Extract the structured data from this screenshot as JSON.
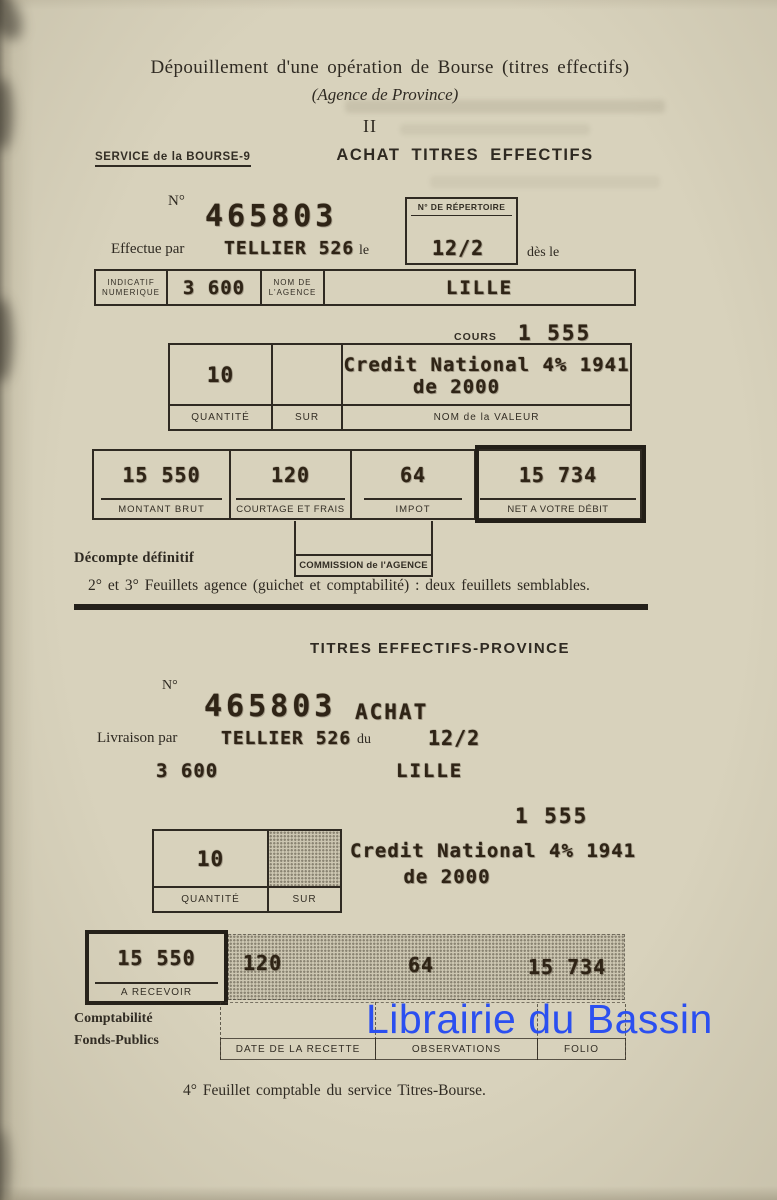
{
  "colors": {
    "watermark_blue": "#2b4ff0",
    "paper": "#d8d2bc",
    "ink": "#2f2a22"
  },
  "header": {
    "title": "Dépouillement d'une opération de Bourse (titres effectifs)",
    "subtitle": "(Agence de Province)",
    "numeral": "II"
  },
  "form1": {
    "service_label": "SERVICE de la BOURSE-9",
    "heading": "ACHAT TITRES EFFECTIFS",
    "numero_label": "N°",
    "numero_value": "465803",
    "repertoire_label": "N° DE RÉPERTOIRE",
    "effectue_label": "Effectue par",
    "effectue_value": "TELLIER 526",
    "le_label": "le",
    "date_value": "12/2",
    "des_le_label": "dès le",
    "indicatif_label_line1": "INDICATIF",
    "indicatif_label_line2": "NUMERIQUE",
    "indicatif_value": "3 600",
    "agence_label_line1": "NOM DE",
    "agence_label_line2": "L'AGENCE",
    "agence_value": "LILLE",
    "cours_label": "COURS",
    "cours_value": "1 555",
    "quantite_value": "10",
    "quantite_label": "QUANTITÉ",
    "sur_label": "SUR",
    "valeur_line1": "Credit National 4% 1941",
    "valeur_line2": "de 2000",
    "valeur_label": "NOM de la VALEUR",
    "montant_cells": [
      {
        "value": "15 550",
        "label": "MONTANT BRUT"
      },
      {
        "value": "120",
        "label": "COURTAGE ET FRAIS"
      },
      {
        "value": "64",
        "label": "IMPOT"
      },
      {
        "value": "15 734",
        "label": "NET A VOTRE DÉBIT"
      }
    ],
    "commission_label": "COMMISSION de l'AGENCE",
    "decompte_label": "Décompte définitif",
    "feuillets_note": "2° et 3° Feuillets agence (guichet et comptabilité) : deux feuillets semblables."
  },
  "form2": {
    "heading": "TITRES EFFECTIFS-PROVINCE",
    "numero_label": "N°",
    "numero_value": "465803",
    "operation_value": "ACHAT",
    "livraison_label": "Livraison par",
    "livraison_value": "TELLIER 526",
    "du_label": "du",
    "date_value": "12/2",
    "indicatif_value": "3 600",
    "agence_value": "LILLE",
    "cours_value": "1 555",
    "quantite_value": "10",
    "quantite_label": "QUANTITÉ",
    "sur_label": "SUR",
    "valeur_line1": "Credit National 4% 1941",
    "valeur_line2": "de 2000",
    "recevoir_value": "15 550",
    "recevoir_label": "A RECEVOIR",
    "courtage_value": "120",
    "impot_value": "64",
    "net_value": "15 734",
    "comptabilite_line1": "Comptabilité",
    "comptabilite_line2": "Fonds-Publics",
    "col_headers": [
      {
        "label": "DATE DE LA RECETTE"
      },
      {
        "label": "OBSERVATIONS"
      },
      {
        "label": "FOLIO"
      }
    ]
  },
  "footer": {
    "note": "4° Feuillet comptable du service Titres-Bourse."
  },
  "watermark": {
    "text": "Librairie du Bassin"
  }
}
